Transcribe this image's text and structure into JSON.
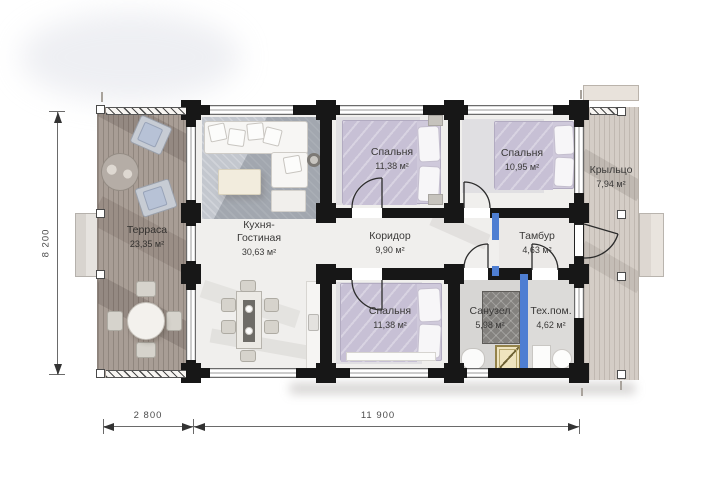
{
  "plan": {
    "rooms": {
      "terrace": {
        "name": "Терраса",
        "area": "23,35 м²"
      },
      "kitchen_living": {
        "name_line1": "Кухня-",
        "name_line2": "Гостиная",
        "area": "30,63 м²"
      },
      "bedroom_top_left": {
        "name": "Спальня",
        "area": "11,38 м²"
      },
      "bedroom_top_right": {
        "name": "Спальня",
        "area": "10,95 м²"
      },
      "bedroom_bottom": {
        "name": "Спальня",
        "area": "11,38 м²"
      },
      "corridor": {
        "name": "Коридор",
        "area": "9,90 м²"
      },
      "tambour": {
        "name": "Тамбур",
        "area": "4,63 м²"
      },
      "bathroom": {
        "name": "Санузел",
        "area": "5,98 м²"
      },
      "tech_room": {
        "name": "Тех.пом.",
        "area": "4,62 м²"
      },
      "porch": {
        "name": "Крыльцо",
        "area": "7,94 м²"
      }
    },
    "dimensions": {
      "overall_depth": "8 200",
      "terrace_width": "2 800",
      "house_length": "11 900"
    },
    "colors": {
      "wall": "#171717",
      "plumbing_partition": "#4e7ed2",
      "terrace_deck": "#a89d95",
      "porch_deck": "#d4cdc6",
      "shower_tray": "#efe4bf"
    }
  }
}
